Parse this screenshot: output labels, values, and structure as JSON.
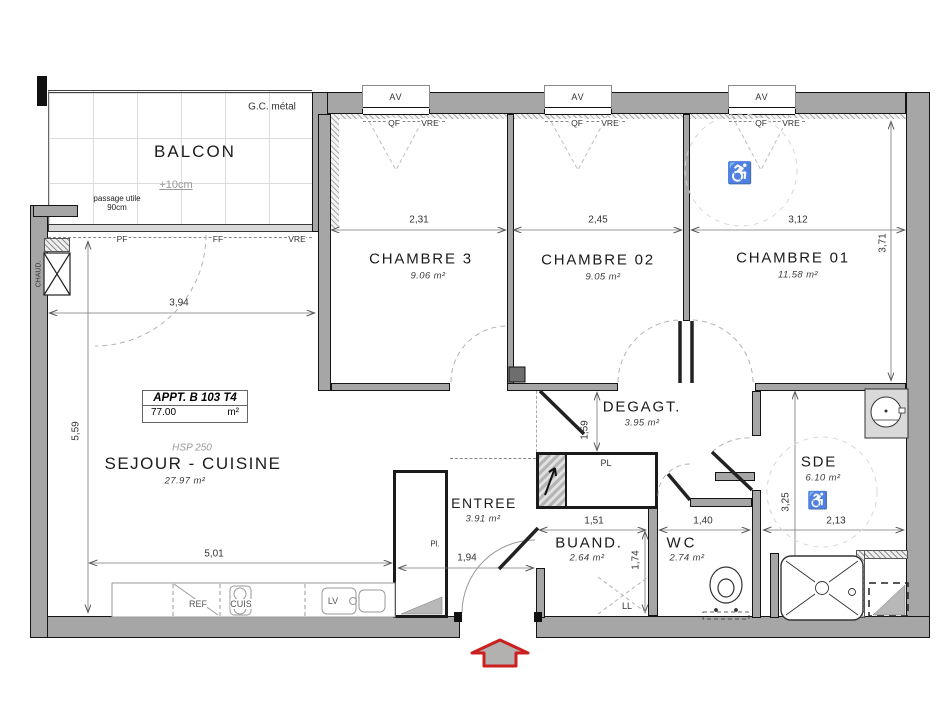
{
  "apartment_box": {
    "name": "APPT. B 103 T4",
    "area_value": "77.00",
    "area_unit": "m²"
  },
  "rooms": {
    "balcon": {
      "name": "BALCON",
      "level_note": "+10cm",
      "guard": "G.C. métal",
      "passage": "passage utile 90cm"
    },
    "sejour": {
      "name": "SEJOUR - CUISINE",
      "area": "27.97 m²",
      "ceiling": "HSP 250"
    },
    "chambre3": {
      "name": "CHAMBRE 3",
      "area": "9.06 m²"
    },
    "chambre02": {
      "name": "CHAMBRE 02",
      "area": "9.05 m²"
    },
    "chambre01": {
      "name": "CHAMBRE 01",
      "area": "11.58 m²"
    },
    "degagt": {
      "name": "DEGAGT.",
      "area": "3.95 m²"
    },
    "entree": {
      "name": "ENTREE",
      "area": "3.91 m²"
    },
    "buand": {
      "name": "BUAND.",
      "area": "2.64 m²"
    },
    "wc": {
      "name": "WC",
      "area": "2.74 m²"
    },
    "sde": {
      "name": "SDE",
      "area": "6.10 m²"
    }
  },
  "openings": {
    "av": "AV",
    "qf": "QF",
    "vre": "VRE",
    "pf": "PF",
    "ff": "FF"
  },
  "equipment": {
    "ref": "REF",
    "cuis": "CUIS",
    "lv": "LV",
    "ll": "LL",
    "pl": "PL",
    "pl_small": "Pl.",
    "chaud": "CHAUD."
  },
  "dimensions": {
    "ch3_w": "2,31",
    "ch2_w": "2,45",
    "ch1_w": "3,12",
    "ch1_h": "3,71",
    "sejour_w": "3,94",
    "sejour_h": "5,59",
    "kitchen_w": "5,01",
    "entree_w": "1,94",
    "buand_w": "1,51",
    "buand_h": "1,74",
    "wc_w": "1,40",
    "sde_h": "3,25",
    "sde_w": "2,13",
    "degagt_h": "1,59"
  },
  "icons": {
    "wheelchair": "♿"
  },
  "colors": {
    "wall": "#a6a6a6",
    "wall_outline": "#141414",
    "entrance_arrow_stroke": "#cc1f1f",
    "entrance_arrow_fill": "#b3b0b0",
    "accessibility": "#cf9d9d",
    "dimension_line": "#777777"
  }
}
